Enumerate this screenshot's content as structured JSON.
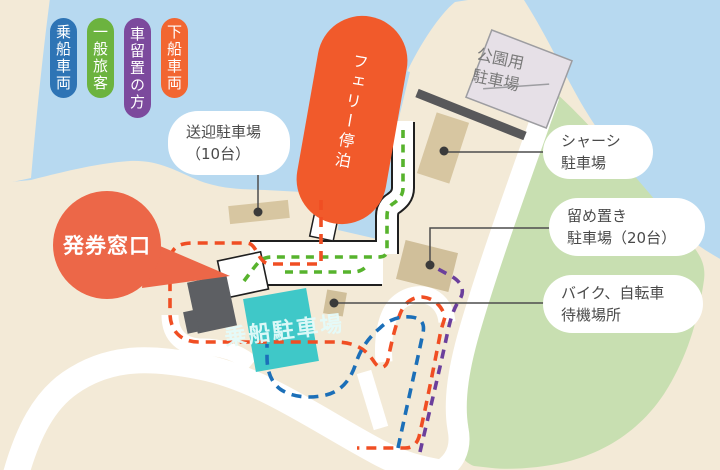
{
  "colors": {
    "water": "#b7d9f0",
    "land": "#f3ead7",
    "park_green": "#c8dfb1",
    "road": "#ffffff",
    "road_outline": "#1f1f1f",
    "tan": "#d7c6a1",
    "tan_dark": "#d0bf9a",
    "gray_building": "#5d5f63",
    "pier": "#58585a",
    "ferry": "#f15a2b",
    "ticket_bubble": "#ec6748",
    "teal": "#3fc8c8",
    "route_red": "#f04e23",
    "route_green": "#57b32d",
    "route_blue": "#1b6fb8",
    "route_purple": "#6b3f9c",
    "leader": "#4d4d4d",
    "parkinglot_fill": "#e6e0e7"
  },
  "legend": {
    "items": [
      {
        "id": "boarding-vehicles",
        "label": "乗船車両",
        "color": "#2e74b5"
      },
      {
        "id": "general-passengers",
        "label": "一般旅客",
        "color": "#6cb33f"
      },
      {
        "id": "car-storage-users",
        "label": "車留置の方",
        "color": "#7c4a9d"
      },
      {
        "id": "disembarking-vehicles",
        "label": "下船車両",
        "color": "#f26631"
      }
    ]
  },
  "labels": {
    "ferry": "フェリー停泊",
    "ticket_window": "発券窓口",
    "boarding_parking": "乗船駐車場",
    "park_parking": {
      "line1": "公園用",
      "line2": "駐車場"
    },
    "pickup_parking": {
      "line1": "送迎駐車場",
      "line2": "（10台）"
    },
    "chassis_parking": {
      "line1": "シャーシ",
      "line2": "駐車場"
    },
    "storage_parking": {
      "line1": "留め置き",
      "line2": "駐車場（20台）"
    },
    "bike_waiting": {
      "line1": "バイク、自転車",
      "line2": "待機場所"
    }
  }
}
